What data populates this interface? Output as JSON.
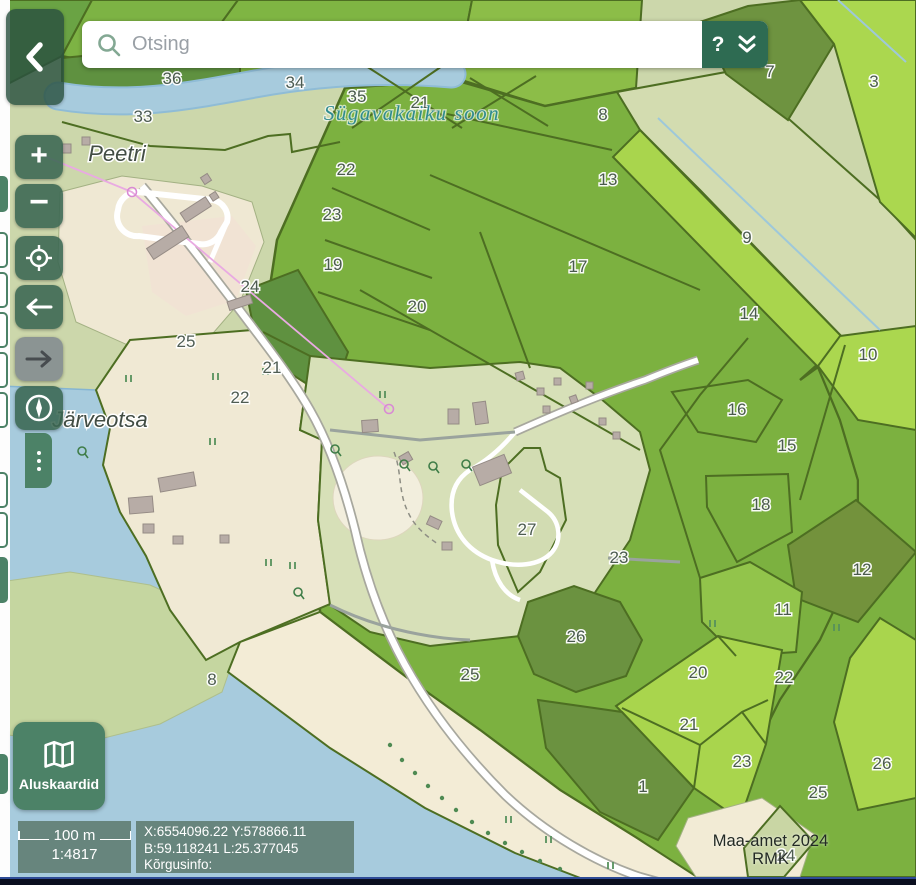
{
  "search": {
    "placeholder": "Otsing",
    "help_label": "?"
  },
  "nav_buttons": {
    "zoom_in": "+",
    "zoom_out": "−"
  },
  "basemap": {
    "label": "Aluskaardid"
  },
  "scale": {
    "distance": "100 m",
    "ratio": "1:4817"
  },
  "status": {
    "coords_xy": "X:6554096.22 Y:578866.11",
    "coords_bl": "B:59.118241 L:25.377045",
    "elevation": "Kõrgusinfo:"
  },
  "attribution": {
    "line1": "Maa-amet 2024",
    "line2": "RMK"
  },
  "icons": {
    "search": "magnifier-icon",
    "collapse": "chevron-left-icon",
    "expand": "double-chevron-down-icon",
    "locate": "crosshair-target-icon",
    "back": "arrow-left-icon",
    "forward": "arrow-right-icon",
    "compass": "compass-icon",
    "basemap": "map-icon",
    "drawer": "vertical-dots-icon"
  },
  "colors": {
    "control_green": "#3a6752",
    "control_green_dark": "#2e6b52",
    "disabled_gray": "#828b8f",
    "overlay_panel": "rgba(88,115,101,0.8)",
    "water": "#a7cbdd",
    "forest_mid": "#7cb140",
    "forest_light": "#a9d54d",
    "forest_dark": "#6b9240",
    "sage": "#ccd7ab",
    "beige": "#f0e9d4",
    "bottom_bar": "#0a0e1f"
  },
  "map": {
    "place_labels": [
      {
        "text": "Peetri",
        "x": 117,
        "y": 161,
        "kind": "settlement"
      },
      {
        "text": "Järveotsa",
        "x": 100,
        "y": 427,
        "kind": "settlement"
      },
      {
        "text": "Sügavakaiku soon",
        "x": 412,
        "y": 120,
        "kind": "wetland"
      }
    ],
    "parcel_labels": [
      {
        "text": "36",
        "x": 172,
        "y": 84
      },
      {
        "text": "34",
        "x": 295,
        "y": 88
      },
      {
        "text": "35",
        "x": 357,
        "y": 102
      },
      {
        "text": "33",
        "x": 143,
        "y": 122
      },
      {
        "text": "21",
        "x": 420,
        "y": 108
      },
      {
        "text": "8",
        "x": 603,
        "y": 120
      },
      {
        "text": "7",
        "x": 770,
        "y": 77
      },
      {
        "text": "3",
        "x": 874,
        "y": 87
      },
      {
        "text": "22",
        "x": 346,
        "y": 175
      },
      {
        "text": "13",
        "x": 608,
        "y": 185
      },
      {
        "text": "23",
        "x": 332,
        "y": 220
      },
      {
        "text": "9",
        "x": 747,
        "y": 243
      },
      {
        "text": "19",
        "x": 333,
        "y": 270
      },
      {
        "text": "17",
        "x": 578,
        "y": 272
      },
      {
        "text": "24",
        "x": 250,
        "y": 292
      },
      {
        "text": "20",
        "x": 417,
        "y": 312
      },
      {
        "text": "14",
        "x": 749,
        "y": 319
      },
      {
        "text": "25",
        "x": 186,
        "y": 347
      },
      {
        "text": "10",
        "x": 868,
        "y": 360
      },
      {
        "text": "21",
        "x": 272,
        "y": 373
      },
      {
        "text": "22",
        "x": 240,
        "y": 403
      },
      {
        "text": "16",
        "x": 737,
        "y": 415
      },
      {
        "text": "15",
        "x": 787,
        "y": 451
      },
      {
        "text": "18",
        "x": 761,
        "y": 510
      },
      {
        "text": "27",
        "x": 527,
        "y": 535
      },
      {
        "text": "23",
        "x": 619,
        "y": 563
      },
      {
        "text": "12",
        "x": 862,
        "y": 575
      },
      {
        "text": "11",
        "x": 783,
        "y": 615
      },
      {
        "text": "26",
        "x": 576,
        "y": 642
      },
      {
        "text": "20",
        "x": 698,
        "y": 678
      },
      {
        "text": "25",
        "x": 470,
        "y": 680
      },
      {
        "text": "22",
        "x": 784,
        "y": 683
      },
      {
        "text": "8",
        "x": 212,
        "y": 685
      },
      {
        "text": "21",
        "x": 689,
        "y": 730
      },
      {
        "text": "23",
        "x": 742,
        "y": 767
      },
      {
        "text": "26",
        "x": 882,
        "y": 769
      },
      {
        "text": "1",
        "x": 643,
        "y": 792
      },
      {
        "text": "25",
        "x": 818,
        "y": 798
      },
      {
        "text": "24",
        "x": 786,
        "y": 861
      }
    ]
  }
}
